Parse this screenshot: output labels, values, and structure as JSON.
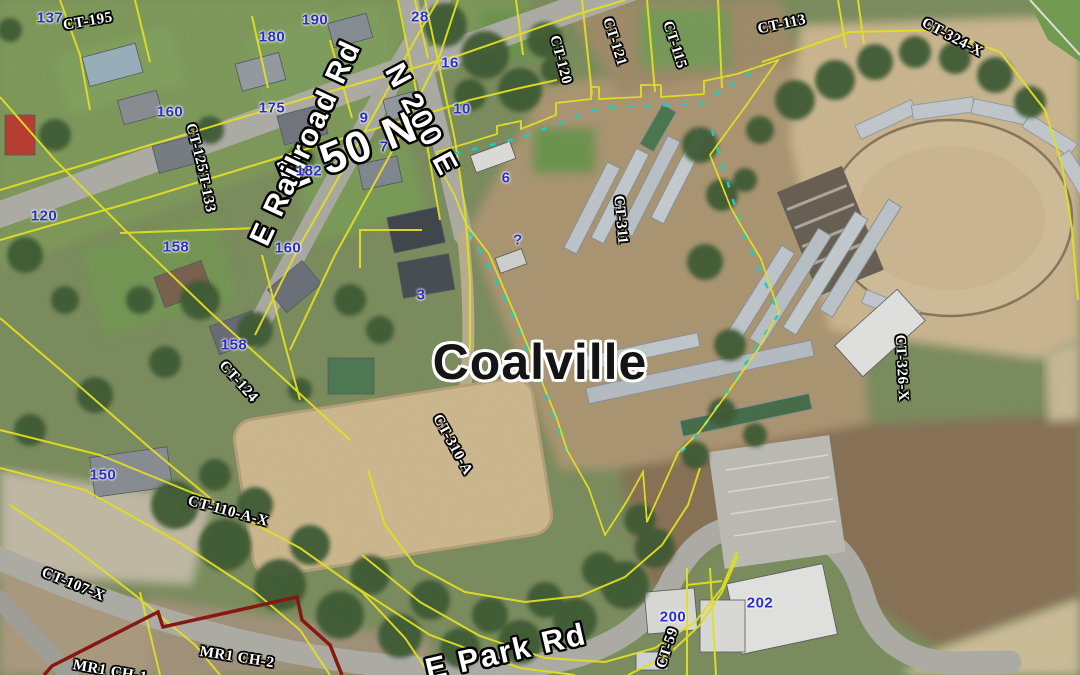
{
  "map": {
    "place_label": "Coalville",
    "colors": {
      "parcel_line": "#f2ef1d",
      "highlight_boundary": "#ea1408",
      "alt_boundary": "#8c1208",
      "utility_line": "#10dcd8",
      "house_number_text": "#2a2fc2",
      "label_text": "#ffffff"
    },
    "street_labels": [
      {
        "text": "E 50 N",
        "x": 348,
        "y": 152,
        "rotate": -22,
        "size": 44
      },
      {
        "text": "E Railroad Rd",
        "x": 306,
        "y": 143,
        "rotate": -65,
        "size": 30
      },
      {
        "text": "N 200 E",
        "x": 421,
        "y": 120,
        "rotate": 62,
        "size": 30
      },
      {
        "text": "E  Park Rd",
        "x": 506,
        "y": 652,
        "rotate": -13,
        "size": 31
      }
    ],
    "parcel_labels": [
      {
        "text": "CT-195",
        "x": 88,
        "y": 22,
        "rotate": -10
      },
      {
        "text": "CT-133",
        "x": 205,
        "y": 188,
        "rotate": 78
      },
      {
        "text": "CT-125",
        "x": 196,
        "y": 148,
        "rotate": 75
      },
      {
        "text": "CT-120",
        "x": 560,
        "y": 60,
        "rotate": 75
      },
      {
        "text": "CT-121",
        "x": 614,
        "y": 42,
        "rotate": 72
      },
      {
        "text": "CT-115",
        "x": 674,
        "y": 45,
        "rotate": 72
      },
      {
        "text": "CT-113",
        "x": 782,
        "y": 25,
        "rotate": -12
      },
      {
        "text": "CT-324-X",
        "x": 952,
        "y": 38,
        "rotate": 28
      },
      {
        "text": "CT-311",
        "x": 620,
        "y": 220,
        "rotate": 85
      },
      {
        "text": "CT-326-X",
        "x": 901,
        "y": 368,
        "rotate": 87
      },
      {
        "text": "CT-310-A",
        "x": 452,
        "y": 445,
        "rotate": 61
      },
      {
        "text": "CT-124",
        "x": 238,
        "y": 382,
        "rotate": 48
      },
      {
        "text": "CT-110-A-X",
        "x": 228,
        "y": 512,
        "rotate": 15
      },
      {
        "text": "CT-107-X",
        "x": 73,
        "y": 585,
        "rotate": 22
      },
      {
        "text": "MR1 CH-2",
        "x": 237,
        "y": 658,
        "rotate": 9
      },
      {
        "text": "MR1 CH-1",
        "x": 110,
        "y": 672,
        "rotate": 10
      },
      {
        "text": "CT-59",
        "x": 668,
        "y": 648,
        "rotate": -72
      }
    ],
    "house_numbers": [
      {
        "text": "137",
        "x": 50,
        "y": 18
      },
      {
        "text": "190",
        "x": 315,
        "y": 20
      },
      {
        "text": "180",
        "x": 272,
        "y": 37
      },
      {
        "text": "28",
        "x": 420,
        "y": 17
      },
      {
        "text": "16",
        "x": 450,
        "y": 63
      },
      {
        "text": "160",
        "x": 170,
        "y": 112
      },
      {
        "text": "175",
        "x": 272,
        "y": 108
      },
      {
        "text": "9",
        "x": 364,
        "y": 118
      },
      {
        "text": "10",
        "x": 462,
        "y": 109
      },
      {
        "text": "7",
        "x": 384,
        "y": 147
      },
      {
        "text": "182",
        "x": 309,
        "y": 171
      },
      {
        "text": "6",
        "x": 506,
        "y": 178
      },
      {
        "text": "120",
        "x": 44,
        "y": 216
      },
      {
        "text": "158",
        "x": 176,
        "y": 247
      },
      {
        "text": "160",
        "x": 288,
        "y": 248
      },
      {
        "text": "158",
        "x": 234,
        "y": 345
      },
      {
        "text": "?",
        "x": 518,
        "y": 240
      },
      {
        "text": "3",
        "x": 421,
        "y": 295
      },
      {
        "text": "150",
        "x": 103,
        "y": 475
      },
      {
        "text": "200",
        "x": 673,
        "y": 617
      },
      {
        "text": "202",
        "x": 760,
        "y": 603
      }
    ]
  }
}
